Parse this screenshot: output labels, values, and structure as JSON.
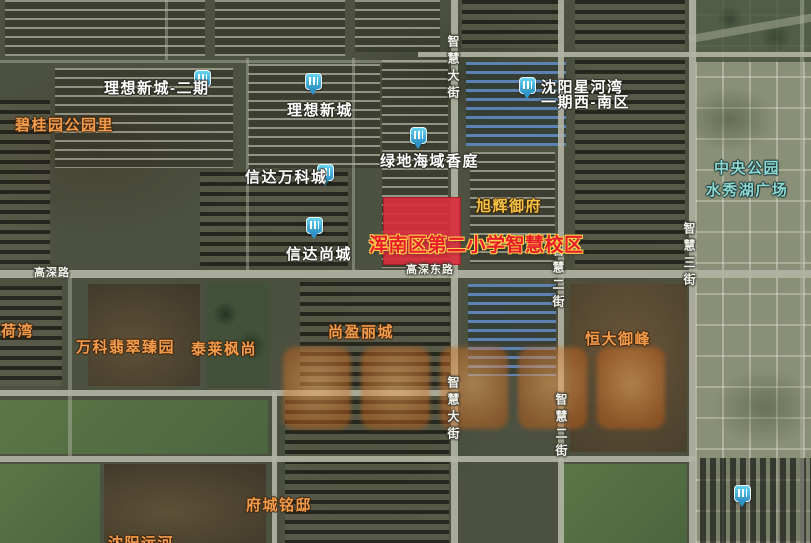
{
  "school": {
    "label": "浑南区第二小学智慧校区",
    "highlight_color": "#d82f3e",
    "label_color": "#e81c2a",
    "label_outline_color": "#ffd24a"
  },
  "pois": [
    {
      "id": "lixiang-xincheng-erqi",
      "text": "理想新城-二期",
      "color": "white"
    },
    {
      "id": "lixiang-xincheng",
      "text": "理想新城",
      "color": "white"
    },
    {
      "id": "lvdi-haiyu-xiangting",
      "text": "绿地海域香庭",
      "color": "white"
    },
    {
      "id": "xinda-wankecheng",
      "text": "信达万科城",
      "color": "white"
    },
    {
      "id": "xinda-shangcheng",
      "text": "信达尚城",
      "color": "white"
    },
    {
      "id": "shenyang-xinghewan",
      "line1": "沈阳星河湾",
      "line2": "一期西-南区",
      "color": "white"
    },
    {
      "id": "biguiyuan-gongyuanli",
      "text": "碧桂园公园里",
      "color": "orange"
    },
    {
      "id": "hewan",
      "text": "荷湾",
      "color": "orange"
    },
    {
      "id": "wanke-feicui-zhenyuan",
      "text": "万科翡翠臻园",
      "color": "orange"
    },
    {
      "id": "tailai-fengshang",
      "text": "泰莱枫尚",
      "color": "orange"
    },
    {
      "id": "shangying-licheng",
      "text": "尚盈丽城",
      "color": "orange"
    },
    {
      "id": "hengda-yufeng",
      "text": "恒大御峰",
      "color": "orange"
    },
    {
      "id": "fucheng-mingdi",
      "text": "府城铭邸",
      "color": "orange"
    },
    {
      "id": "shenyang-yunhe",
      "text": "沈阳运河",
      "color": "orange"
    },
    {
      "id": "xuhui-yufu",
      "text": "旭辉御府",
      "color": "yellow"
    },
    {
      "id": "zhongyang-gongyuan",
      "line1": "中央公园",
      "line2": "水秀湖广场",
      "color": "cyan"
    }
  ],
  "streets": [
    {
      "id": "zhihui-dajie-north",
      "text": "智慧大街",
      "orientation": "vertical"
    },
    {
      "id": "zhihui-dajie-south",
      "text": "智慧大街",
      "orientation": "vertical"
    },
    {
      "id": "zhihui-erjie-north",
      "text": "智慧二街",
      "orientation": "vertical"
    },
    {
      "id": "zhihui-erjie-south",
      "text": "智慧二街",
      "orientation": "vertical"
    },
    {
      "id": "zhihui-sanjie",
      "text": "智慧三街",
      "orientation": "vertical"
    },
    {
      "id": "gaoshen-lu",
      "text": "高深路",
      "orientation": "horizontal"
    },
    {
      "id": "gaoshen-donglu",
      "text": "高深东路",
      "orientation": "horizontal"
    }
  ],
  "colors": {
    "label_white": "#ffffff",
    "label_orange": "#f49c4b",
    "label_yellow": "#f6c243",
    "label_cyan": "#8ed9d2",
    "road": "#b3b5a4",
    "pin_blue": "#2e93c6"
  },
  "watermark": {
    "color": "#cf6f22",
    "opacity": 0.55
  }
}
